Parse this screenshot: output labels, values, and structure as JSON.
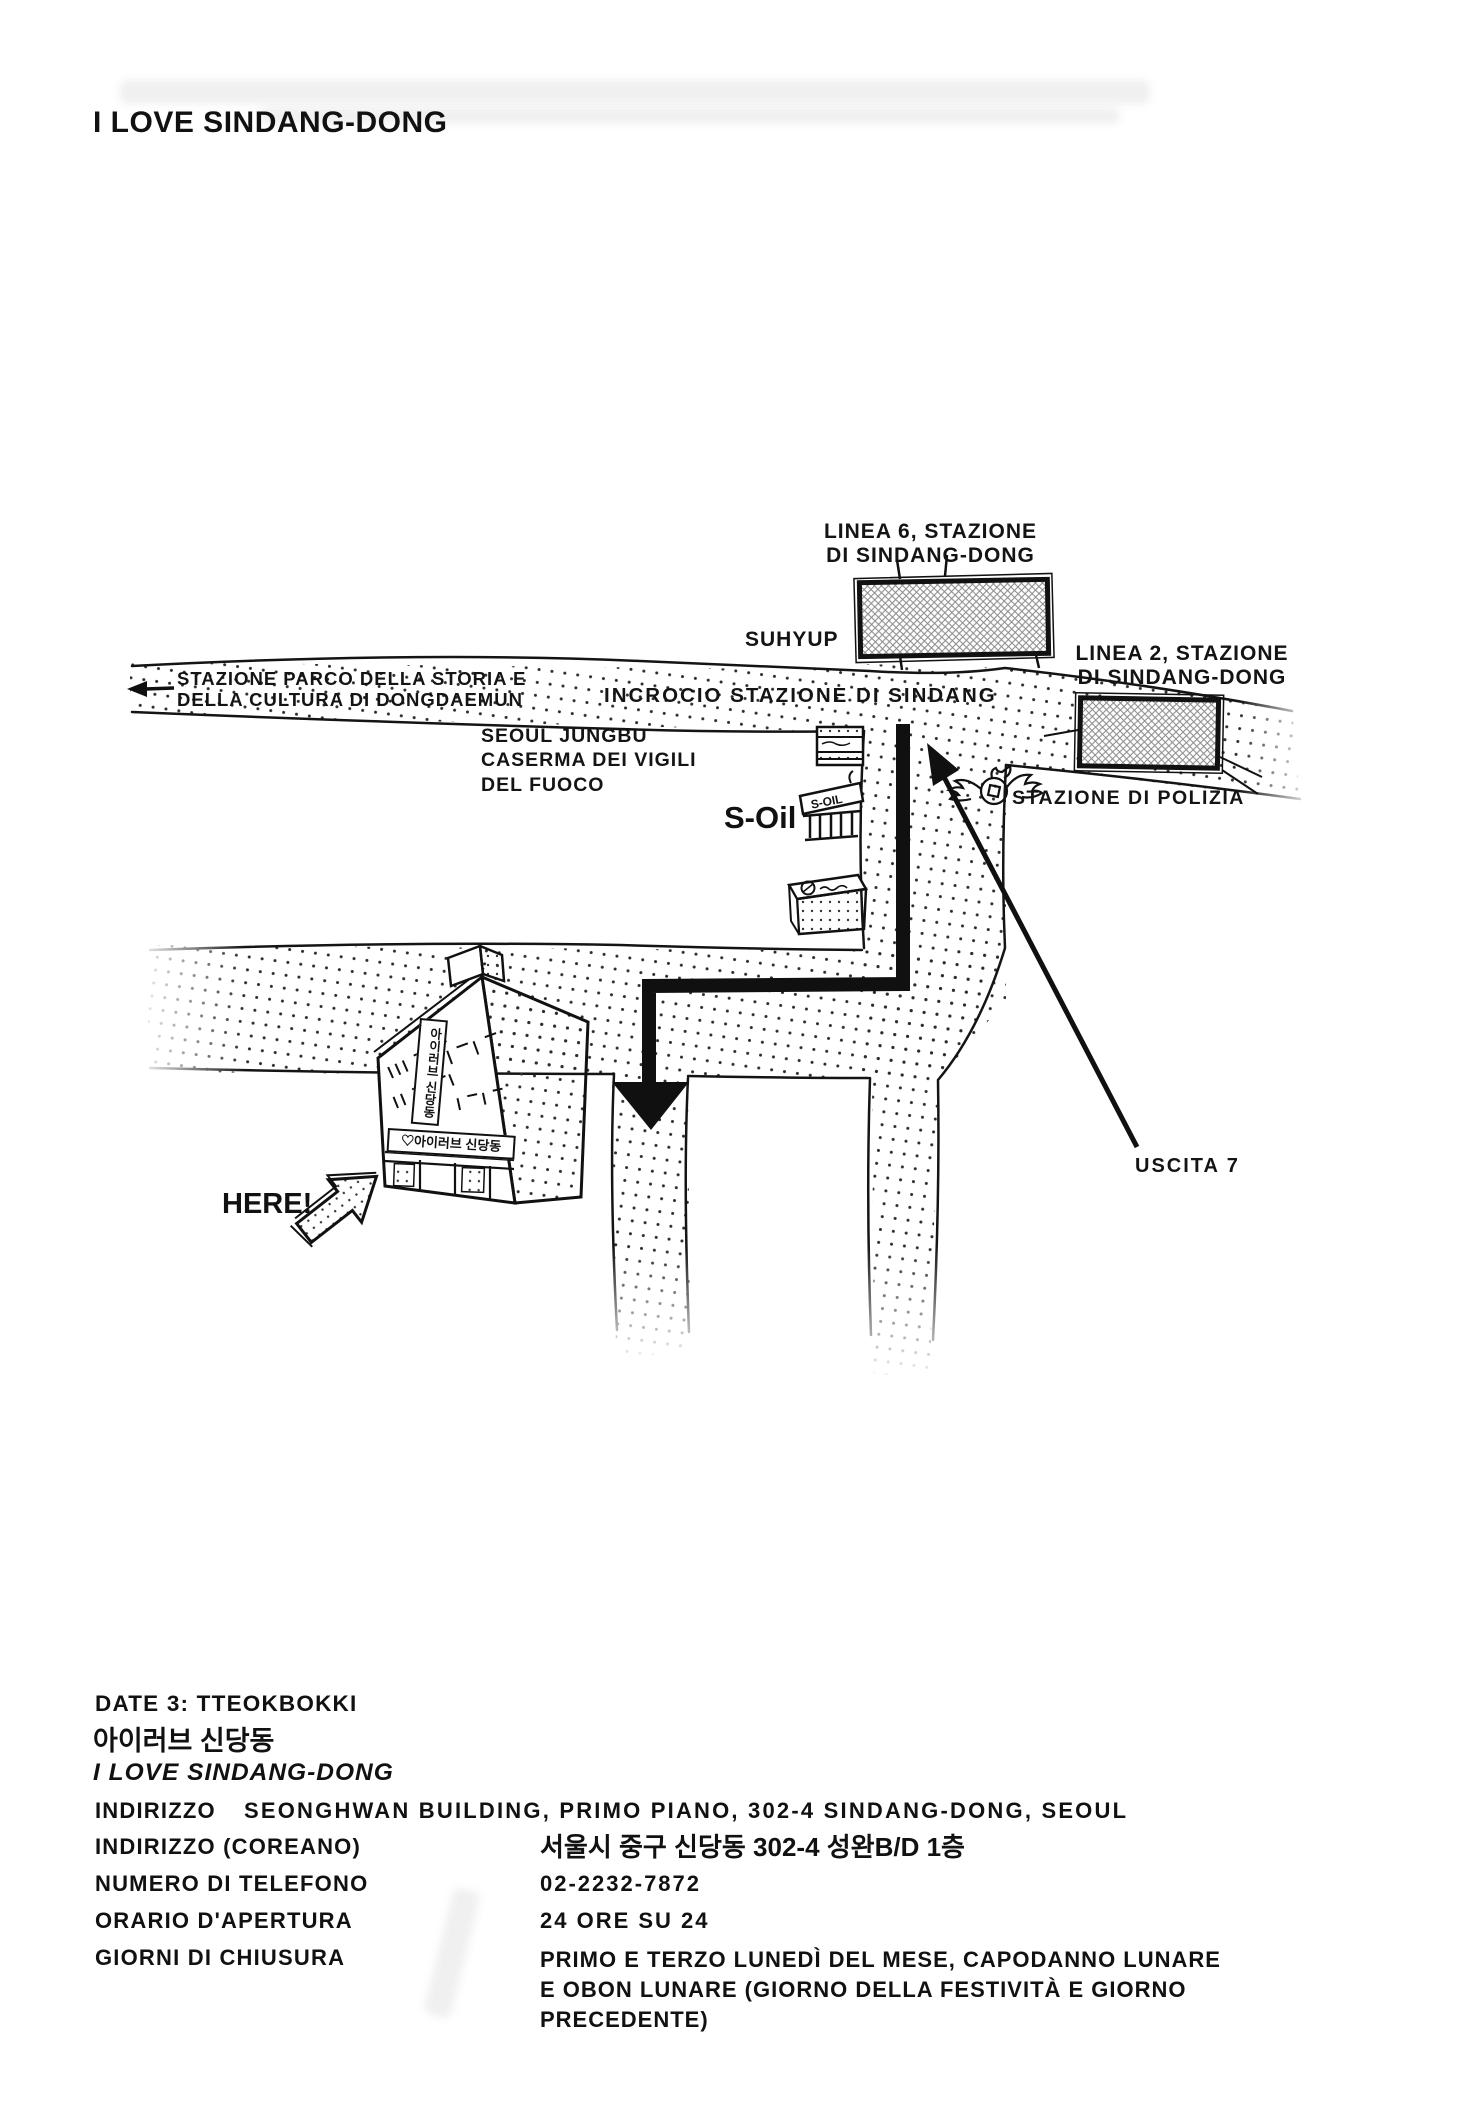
{
  "page": {
    "title": "I LOVE SINDANG-DONG"
  },
  "colors": {
    "ink": "#141414",
    "paper": "#ffffff"
  },
  "map": {
    "labels": {
      "line6_station": "LINEA 6, STAZIONE\nDI SINDANG-DONG",
      "line2_station": "LINEA 2, STAZIONE\nDI SINDANG-DONG",
      "suhyup": "SUHYUP",
      "dongdaemun": "STAZIONE PARCO DELLA STORIA E\nDELLA CULTURA DI DONGDAEMUN",
      "incrocio": "INCROCIO STAZIONE DI SINDANG",
      "fire_station": "SEOUL JUNGBU\nCASERMA DEI VIGILI\nDEL FUOCO",
      "s_oil": "S-Oil",
      "police": "STAZIONE DI POLIZIA",
      "exit7": "USCITA 7",
      "here": "HERE!"
    },
    "soil_sign": "S-OIL",
    "building": {
      "banner_sign": "♡아이러브 신당동",
      "vertical_sign": "아이러브 신당동"
    }
  },
  "info": {
    "date_line": "DATE 3: TTEOKBOKKI",
    "korean_name": "아이러브 신당동",
    "name": "I LOVE SINDANG-DONG",
    "rows": [
      {
        "label": "INDIRIZZO",
        "value": "SEONGHWAN BUILDING, PRIMO PIANO, 302-4 SINDANG-DONG, SEOUL"
      },
      {
        "label": "INDIRIZZO (COREANO)",
        "value": "서울시 중구 신당동 302-4 성완B/D 1층"
      },
      {
        "label": "NUMERO DI TELEFONO",
        "value": "02-2232-7872"
      },
      {
        "label": "ORARIO D'APERTURA",
        "value": "24 ORE SU 24"
      },
      {
        "label": "GIORNI DI CHIUSURA",
        "value": "PRIMO E TERZO LUNEDÌ DEL MESE, CAPODANNO LUNARE\nE OBON LUNARE (GIORNO DELLA FESTIVITÀ E GIORNO\nPRECEDENTE)"
      }
    ]
  }
}
